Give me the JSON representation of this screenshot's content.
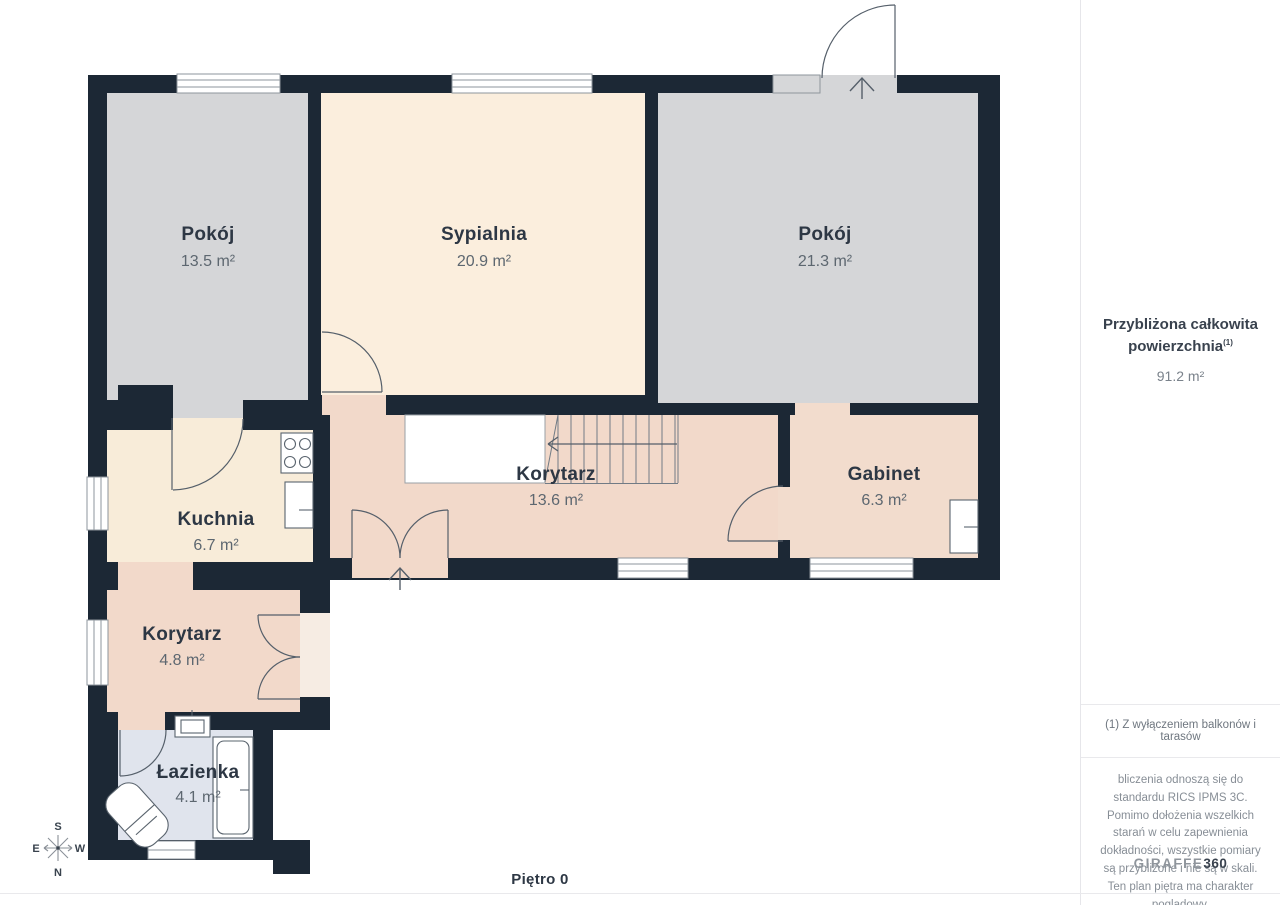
{
  "floor_label": "Piętro 0",
  "rooms": [
    {
      "name": "Pokój",
      "area": "13.5 m²"
    },
    {
      "name": "Sypialnia",
      "area": "20.9 m²"
    },
    {
      "name": "Pokój",
      "area": "21.3 m²"
    },
    {
      "name": "Korytarz",
      "area": "13.6 m²"
    },
    {
      "name": "Gabinet",
      "area": "6.3 m²"
    },
    {
      "name": "Kuchnia",
      "area": "6.7 m²"
    },
    {
      "name": "Korytarz",
      "area": "4.8 m²"
    },
    {
      "name": "Łazienka",
      "area": "4.1 m²"
    }
  ],
  "sidebar": {
    "total_area_title": "Przybliżona całkowita powierzchnia",
    "total_area_sup": "(1)",
    "total_area_value": "91.2 m²",
    "footnote": "(1) Z wyłączeniem balkonów i tarasów",
    "disclaimer": "bliczenia odnoszą się do standardu RICS IPMS 3C. Pomimo dołożenia wszelkich starań w celu zapewnienia dokładności, wszystkie pomiary są przybliżone i nie są w skali. Ten plan piętra ma charakter poglądowy.",
    "brand_name": "GIRAFFE",
    "brand_number": "360"
  },
  "compass": {
    "top": "S",
    "left": "E",
    "right": "W",
    "bottom": "N"
  },
  "colors": {
    "wall": "#1c2835",
    "room_gray": "#d5d6d8",
    "room_cream": "#f9ecda",
    "room_pink": "#f2d9ca",
    "room_bath": "#e0e4ed",
    "line": "#555f6a"
  }
}
